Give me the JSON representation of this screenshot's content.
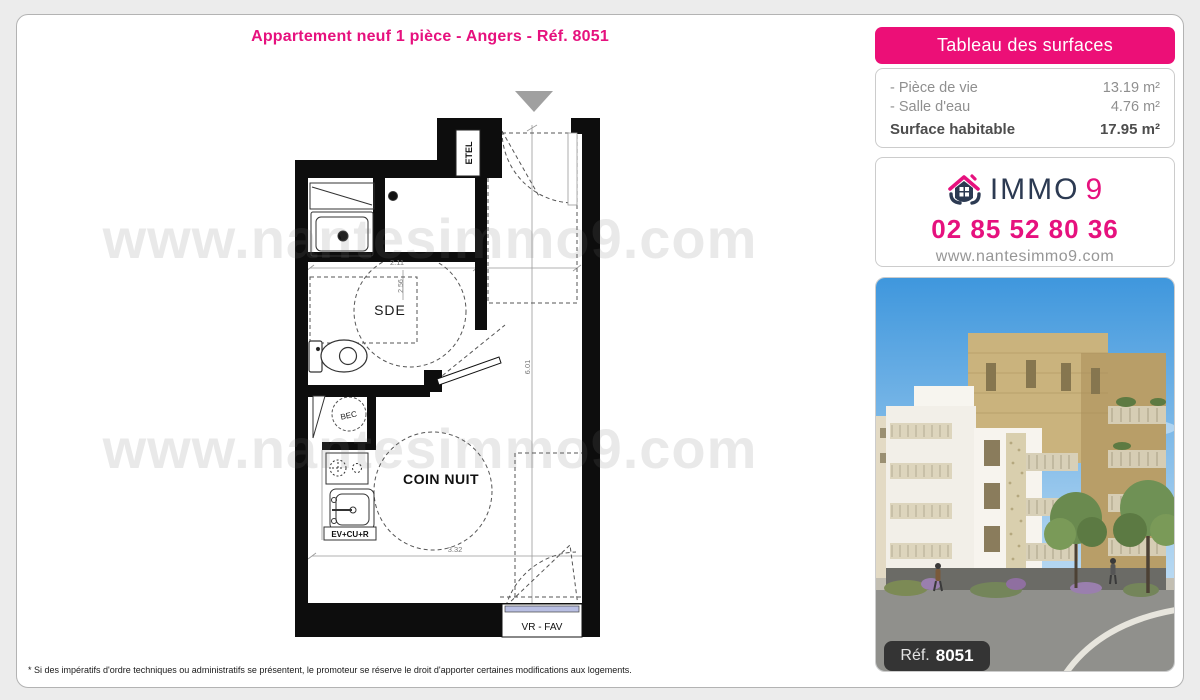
{
  "page": {
    "title": "Appartement neuf 1 pièce - Angers - Réf. 8051",
    "disclaimer": "* Si des impératifs d'ordre techniques ou administratifs se présentent, le promoteur se réserve le droit d'apporter certaines modifications aux logements."
  },
  "watermark": {
    "text": "www.nantesimmo9.com"
  },
  "surfaces": {
    "header": "Tableau des surfaces",
    "rows": [
      {
        "label": "- Pièce de vie",
        "value": "13.19 m²"
      },
      {
        "label": "- Salle d'eau",
        "value": "4.76 m²"
      }
    ],
    "total_label": "Surface habitable",
    "total_value": "17.95 m²"
  },
  "agency": {
    "brand_immo": "IMMO",
    "brand_9": "9",
    "phone": "02 85 52 80 36",
    "website": "www.nantesimmo9.com"
  },
  "photo": {
    "ref_label": "Réf.",
    "ref_number": "8051"
  },
  "plan": {
    "labels": {
      "etel": "ETEL",
      "sde": "SDE",
      "bec": "BEC",
      "coin_nuit": "COIN NUIT",
      "kitchen_unit": "EV+CU+R",
      "window_unit": "VR - FAV"
    },
    "dims": {
      "sde_width": "2.11",
      "sde_depth": "2.56",
      "room_height": "6.01",
      "room_width": "3.32"
    }
  },
  "colors": {
    "accent_pink": "#e6117e",
    "navy": "#2c3a52",
    "glazing_blue": "#b9bfe3"
  }
}
